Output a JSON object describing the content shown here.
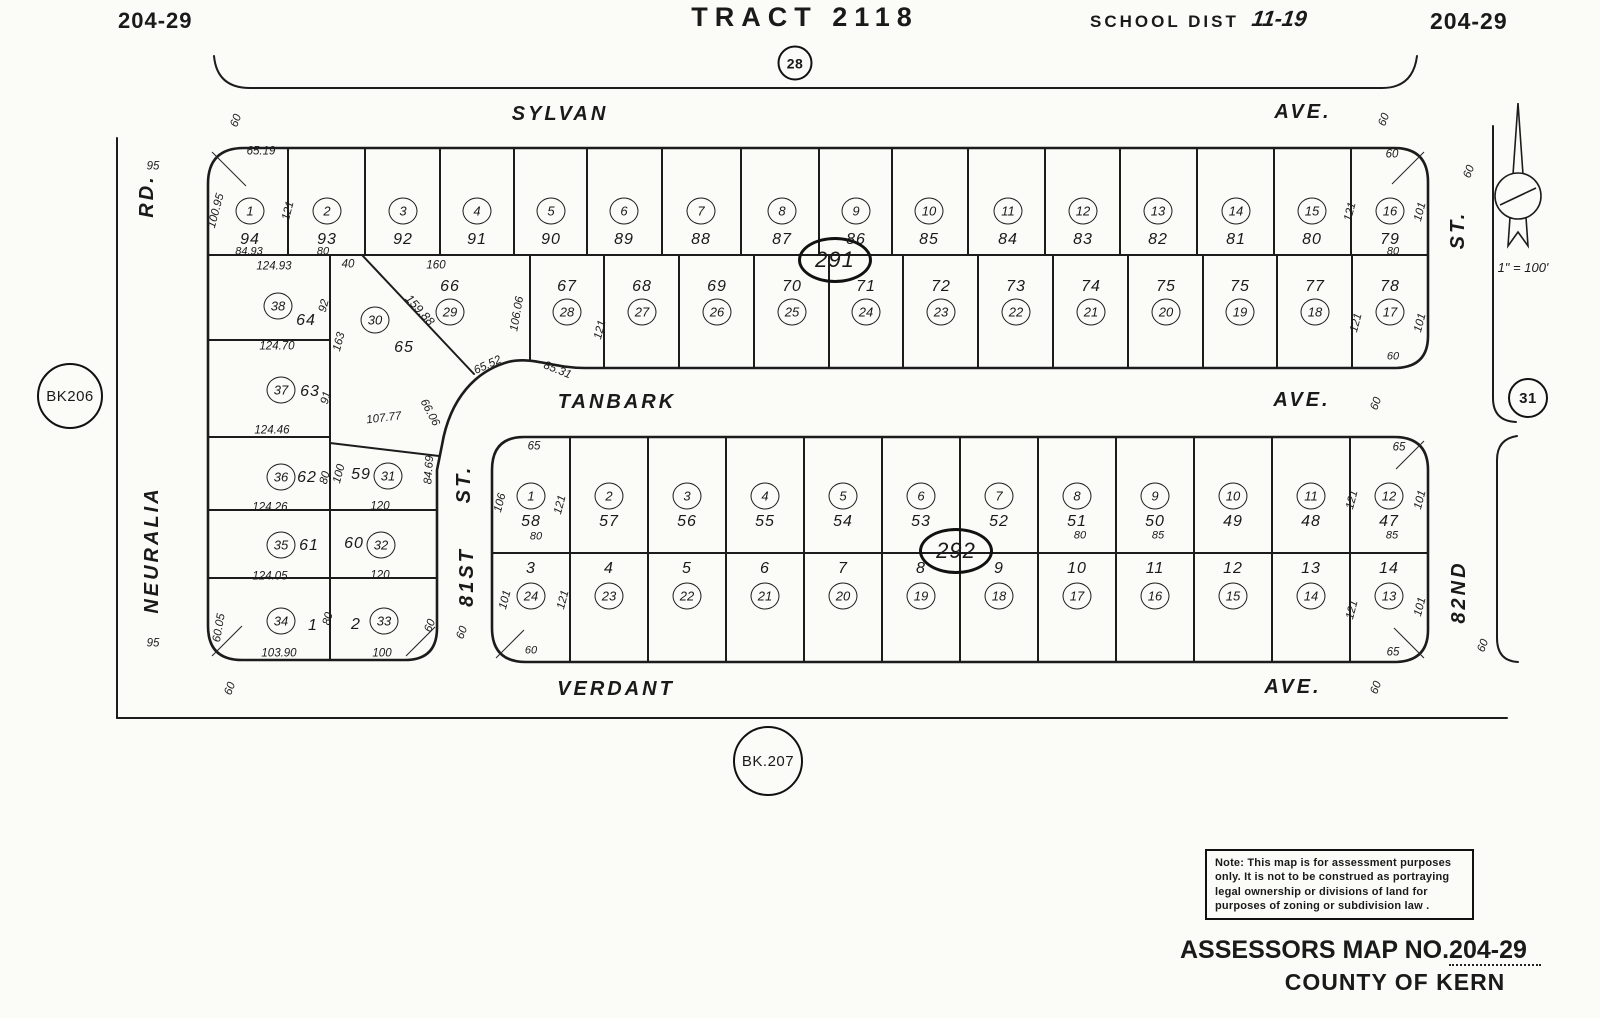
{
  "header": {
    "map_no_left": "204-29",
    "tract": "TRACT 2118",
    "school_dist_label": "SCHOOL DIST",
    "school_dist_value": "11-19",
    "map_no_right": "204-29",
    "top_circle": "28"
  },
  "footer": {
    "title": "ASSESSORS MAP NO.",
    "map_no": "204-29",
    "county": "COUNTY OF KERN"
  },
  "note": {
    "lines": [
      "Note: This map is for assessment purposes",
      "only. It is not to be construed as portraying",
      "legal ownership or divisions of land for",
      "purposes of zoning or subdivision law ."
    ]
  },
  "scale_label": "1\" = 100'",
  "ref_circles": {
    "book_left": "BK206",
    "book_bottom": "BK.207",
    "section_right": "31"
  },
  "blocks": {
    "b291": {
      "label": "291",
      "row1": {
        "circles": [
          "1",
          "2",
          "3",
          "4",
          "5",
          "6",
          "7",
          "8",
          "9",
          "10",
          "11",
          "12",
          "13",
          "14",
          "15",
          "16"
        ],
        "lots": [
          "94",
          "93",
          "92",
          "91",
          "90",
          "89",
          "88",
          "87",
          "86",
          "85",
          "84",
          "83",
          "82",
          "81",
          "80",
          "79"
        ]
      },
      "row2": {
        "circles": [
          "29",
          "28",
          "27",
          "26",
          "25",
          "24",
          "23",
          "22",
          "21",
          "20",
          "19",
          "18",
          "17"
        ],
        "lots": [
          "66",
          "67",
          "68",
          "69",
          "70",
          "71",
          "72",
          "73",
          "74",
          "75",
          "75",
          "77",
          "78"
        ]
      }
    },
    "b292": {
      "label": "292",
      "row1": {
        "circles": [
          "1",
          "2",
          "3",
          "4",
          "5",
          "6",
          "7",
          "8",
          "9",
          "10",
          "11",
          "12"
        ],
        "lots": [
          "58",
          "57",
          "56",
          "55",
          "54",
          "53",
          "52",
          "51",
          "50",
          "49",
          "48",
          "47"
        ]
      },
      "row2": {
        "circles": [
          "24",
          "23",
          "22",
          "21",
          "20",
          "19",
          "18",
          "17",
          "16",
          "15",
          "14",
          "13"
        ],
        "lots": [
          "3",
          "4",
          "5",
          "6",
          "7",
          "8",
          "9",
          "10",
          "11",
          "12",
          "13",
          "14"
        ]
      }
    },
    "west": {
      "parcels": [
        {
          "circle": "38",
          "lot": "64"
        },
        {
          "circle": "30",
          "lot": "65"
        },
        {
          "circle": "37",
          "lot": "63"
        },
        {
          "circle": "36",
          "lot": "62"
        },
        {
          "circle": "31",
          "lot": "59"
        },
        {
          "circle": "35",
          "lot": "61"
        },
        {
          "circle": "32",
          "lot": "60"
        },
        {
          "circle": "34",
          "lot": "1"
        },
        {
          "circle": "33",
          "lot": "2"
        }
      ]
    }
  },
  "streets": [
    {
      "t": "SYLVAN",
      "x": 560,
      "y": 114,
      "r": 0
    },
    {
      "t": "AVE.",
      "x": 1303,
      "y": 112,
      "r": 0
    },
    {
      "t": "TANBARK",
      "x": 617,
      "y": 402,
      "r": 0
    },
    {
      "t": "AVE.",
      "x": 1302,
      "y": 400,
      "r": 0
    },
    {
      "t": "VERDANT",
      "x": 616,
      "y": 689,
      "r": 0
    },
    {
      "t": "AVE.",
      "x": 1293,
      "y": 687,
      "r": 0
    },
    {
      "t": "NEURALIA",
      "x": 152,
      "y": 550,
      "r": -90
    },
    {
      "t": "RD.",
      "x": 147,
      "y": 196,
      "r": -90
    },
    {
      "t": "81ST",
      "x": 467,
      "y": 577,
      "r": -90
    },
    {
      "t": "ST.",
      "x": 464,
      "y": 484,
      "r": -90
    },
    {
      "t": "82ND",
      "x": 1459,
      "y": 592,
      "r": -90
    },
    {
      "t": "ST.",
      "x": 1458,
      "y": 230,
      "r": -90
    }
  ],
  "dims": [
    {
      "t": "60",
      "x": 237,
      "y": 121,
      "r": -70
    },
    {
      "t": "60",
      "x": 1385,
      "y": 120,
      "r": -70
    },
    {
      "t": "60",
      "x": 1470,
      "y": 172,
      "r": -70
    },
    {
      "t": "95",
      "x": 153,
      "y": 167
    },
    {
      "t": "65.19",
      "x": 261,
      "y": 152
    },
    {
      "t": "100.95",
      "x": 217,
      "y": 211,
      "r": -75
    },
    {
      "t": "121",
      "x": 289,
      "y": 211,
      "r": -75
    },
    {
      "t": "84.93",
      "x": 249,
      "y": 252,
      "s": 11
    },
    {
      "t": "80",
      "x": 323,
      "y": 252,
      "s": 11
    },
    {
      "t": "60",
      "x": 1392,
      "y": 155
    },
    {
      "t": "121",
      "x": 1351,
      "y": 212,
      "r": -75
    },
    {
      "t": "101",
      "x": 1421,
      "y": 212,
      "r": -75
    },
    {
      "t": "80",
      "x": 1393,
      "y": 252,
      "s": 11
    },
    {
      "t": "124.93",
      "x": 274,
      "y": 267
    },
    {
      "t": "40",
      "x": 348,
      "y": 265
    },
    {
      "t": "160",
      "x": 436,
      "y": 266
    },
    {
      "t": "92",
      "x": 325,
      "y": 306,
      "r": -75
    },
    {
      "t": "159.88",
      "x": 420,
      "y": 310,
      "r": 48,
      "s": 12
    },
    {
      "t": "106.06",
      "x": 518,
      "y": 314,
      "r": -80
    },
    {
      "t": "121",
      "x": 601,
      "y": 330,
      "r": -75
    },
    {
      "t": "121",
      "x": 1357,
      "y": 323,
      "r": -75
    },
    {
      "t": "101",
      "x": 1421,
      "y": 323,
      "r": -75
    },
    {
      "t": "60",
      "x": 1393,
      "y": 357,
      "s": 11
    },
    {
      "t": "124.70",
      "x": 277,
      "y": 347
    },
    {
      "t": "163",
      "x": 340,
      "y": 342,
      "r": -75
    },
    {
      "t": "91",
      "x": 327,
      "y": 398,
      "r": -75
    },
    {
      "t": "124.46",
      "x": 272,
      "y": 431
    },
    {
      "t": "107.77",
      "x": 384,
      "y": 419,
      "r": -7
    },
    {
      "t": "66.06",
      "x": 429,
      "y": 413,
      "r": 62
    },
    {
      "t": "65.52",
      "x": 488,
      "y": 366,
      "r": -25
    },
    {
      "t": "85.31",
      "x": 557,
      "y": 371,
      "r": 22
    },
    {
      "t": "84.69",
      "x": 430,
      "y": 470,
      "r": -86
    },
    {
      "t": "80",
      "x": 326,
      "y": 478,
      "r": -75
    },
    {
      "t": "100",
      "x": 340,
      "y": 474,
      "r": -75
    },
    {
      "t": "124.26",
      "x": 270,
      "y": 508
    },
    {
      "t": "120",
      "x": 380,
      "y": 507
    },
    {
      "t": "124.05",
      "x": 270,
      "y": 577
    },
    {
      "t": "120",
      "x": 380,
      "y": 576
    },
    {
      "t": "80",
      "x": 329,
      "y": 619,
      "r": -75
    },
    {
      "t": "60.05",
      "x": 220,
      "y": 628,
      "r": -80
    },
    {
      "t": "103.90",
      "x": 279,
      "y": 654
    },
    {
      "t": "100",
      "x": 382,
      "y": 654
    },
    {
      "t": "60",
      "x": 431,
      "y": 626,
      "r": -70
    },
    {
      "t": "95",
      "x": 153,
      "y": 644
    },
    {
      "t": "60",
      "x": 463,
      "y": 633,
      "r": -70
    },
    {
      "t": "60",
      "x": 1377,
      "y": 404,
      "r": -70
    },
    {
      "t": "65",
      "x": 534,
      "y": 447
    },
    {
      "t": "65",
      "x": 1399,
      "y": 448
    },
    {
      "t": "106",
      "x": 501,
      "y": 503,
      "r": -75
    },
    {
      "t": "121",
      "x": 561,
      "y": 505,
      "r": -75
    },
    {
      "t": "121",
      "x": 1353,
      "y": 500,
      "r": -75
    },
    {
      "t": "101",
      "x": 1421,
      "y": 500,
      "r": -75
    },
    {
      "t": "80",
      "x": 536,
      "y": 537,
      "s": 11
    },
    {
      "t": "80",
      "x": 1080,
      "y": 536,
      "s": 11
    },
    {
      "t": "85",
      "x": 1158,
      "y": 536,
      "s": 11
    },
    {
      "t": "85",
      "x": 1392,
      "y": 536,
      "s": 11
    },
    {
      "t": "101",
      "x": 506,
      "y": 600,
      "r": -75
    },
    {
      "t": "121",
      "x": 564,
      "y": 600,
      "r": -75
    },
    {
      "t": "121",
      "x": 1353,
      "y": 610,
      "r": -75
    },
    {
      "t": "101",
      "x": 1421,
      "y": 607,
      "r": -75
    },
    {
      "t": "60",
      "x": 531,
      "y": 651,
      "s": 11
    },
    {
      "t": "65",
      "x": 1393,
      "y": 653
    },
    {
      "t": "60",
      "x": 231,
      "y": 689,
      "r": -70
    },
    {
      "t": "60",
      "x": 1377,
      "y": 688,
      "r": -70
    },
    {
      "t": "60",
      "x": 1484,
      "y": 646,
      "r": -70
    }
  ]
}
